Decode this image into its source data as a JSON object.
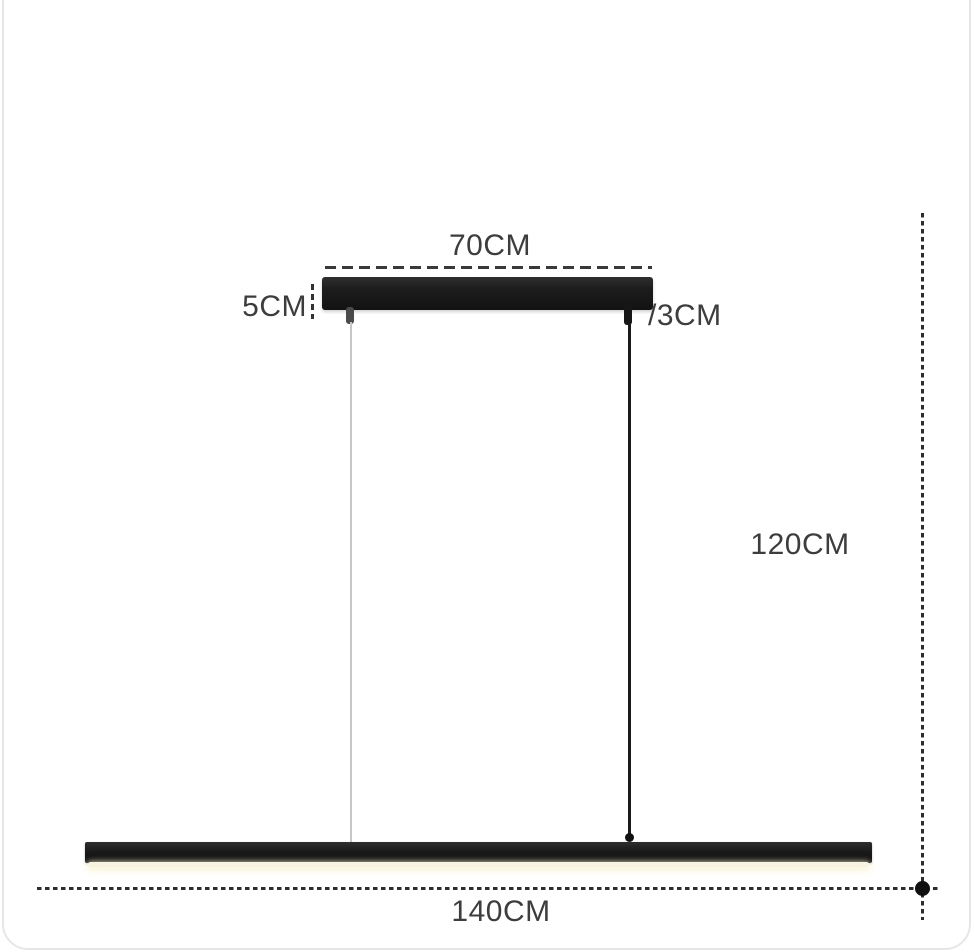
{
  "diagram": {
    "type": "pendant-lamp-dimension-diagram",
    "labels": {
      "canopy_width": "70CM",
      "canopy_height": "5CM",
      "cord_size": "/3CM",
      "drop_height": "120CM",
      "bar_length": "140CM"
    },
    "colors": {
      "fixture_black": "#1a1a1a",
      "dimension_text": "#3d3d3d",
      "dashed_line": "#333333",
      "wire_light_gray": "#c6c6c6",
      "led_glow": "#f7f3e0",
      "card_border": "#e6e6e6",
      "background": "#ffffff"
    }
  }
}
